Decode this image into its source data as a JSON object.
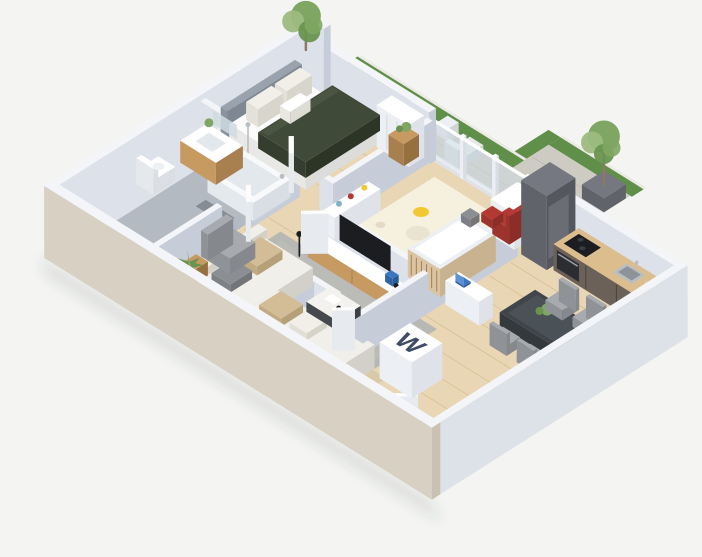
{
  "meta": {
    "description": "3D isometric floor-plan rendering of a two-bedroom apartment with wrap-around terrace",
    "view": "isometric-render",
    "background": "#f4f4f2"
  },
  "palette": {
    "bg": "#f4f4f2",
    "wallTop": "#f3f5f8",
    "wallFace": "#dde2ea",
    "wallFaceDark": "#c6cdd8",
    "wallBeige": "#d7d0c3",
    "wallBeigeDark": "#c9c1b1",
    "glass": "#cfe0e8",
    "floorWood": "#e9d6b4",
    "floorWoodLine": "#d8c094",
    "floorBath": "#b4bac2",
    "floorWc": "#ced2d8",
    "rugGray": "#b7b7b4",
    "rugCream": "#f6f0df",
    "paving": "#cecbc3",
    "curb": "#eceae4",
    "grass": "#5f8f49",
    "treeGreen": "#7fa763",
    "treeLight": "#9cbb80",
    "treeDark": "#69934f",
    "trunk": "#8a7a66",
    "duvet": "#404a38",
    "headboard": "#9aa3ad",
    "mattress": "#fbfbfb",
    "pillow": "#f1efe8",
    "wood": "#c79a62",
    "woodDark": "#a87f4e",
    "white": "#ffffff",
    "offWhite": "#eceff3",
    "tub": "#f7f9fa",
    "tubIn": "#e2e8ec",
    "steel": "#b9bec4",
    "black": "#1b1d21",
    "darkGray": "#55585e",
    "midGray": "#9aa0a6",
    "sofa": "#f0efea",
    "sofaSide": "#dedcd5",
    "cushTan": "#d2bd96",
    "cushGray": "#8b8e92",
    "tableDark": "#3f454a",
    "tableSheen": "#555d63",
    "chair": "#a7abaf",
    "chairDark": "#8f9397",
    "red": "#b23a32",
    "yellow": "#f0c832",
    "blue": "#3a77c2",
    "navy": "#3f4c63",
    "counter": "#dcbd8e",
    "cabinet": "#6b6158",
    "cabinetDark": "#594f46",
    "tower": "#757880",
    "towerDark": "#60636a",
    "matTan": "#d9c9a7",
    "matGray": "#9aa0a8",
    "oven": "#2c2d31",
    "shadow": "rgba(60,62,70,0.12)"
  },
  "scene": {
    "monogram": "W",
    "rooms": [
      {
        "name": "master-bedroom",
        "floor": "wood",
        "furniture": [
          "double-bed",
          "gray-headboard",
          "green-duvet",
          "pillows",
          "round-bedside-table",
          "potted-plant",
          "wardrobe-closet",
          "towel-shelf"
        ]
      },
      {
        "name": "bathroom",
        "floor": "gray-tile",
        "furniture": [
          "bathtub",
          "shower-fixture",
          "wood-vanity-sink",
          "toilet",
          "bath-mat",
          "mirror"
        ]
      },
      {
        "name": "kids-room",
        "floor": "wood-with-cream-rug",
        "furniture": [
          "crib",
          "red-armchair",
          "cube-shelf",
          "low-shelf",
          "play-cushions",
          "rug-decals"
        ]
      },
      {
        "name": "living-room",
        "floor": "wood-with-gray-rug",
        "furniture": [
          "corner-sofa",
          "seat-cushions",
          "coffee-table",
          "magazine",
          "armchair",
          "side-table",
          "tv-sideboard",
          "wall-tv",
          "picture-frame",
          "floor-lamp",
          "palm-plant"
        ]
      },
      {
        "name": "kitchen",
        "floor": "wood",
        "furniture": [
          "tall-cabinet-column",
          "counter-cabinets",
          "cooktop",
          "oven",
          "sink",
          "bottles"
        ]
      },
      {
        "name": "dining-area",
        "floor": "wood",
        "furniture": [
          "dining-table",
          "dining-chairs-x4",
          "table-plant"
        ]
      },
      {
        "name": "wc",
        "floor": "light-tile",
        "furniture": [
          "toilet"
        ]
      },
      {
        "name": "entry-hall",
        "floor": "wood",
        "furniture": [
          "monogram-wardrobe",
          "desk-with-laptop",
          "beige-doormat",
          "gray-doormat",
          "front-door"
        ]
      },
      {
        "name": "terrace",
        "floor": "stone-paving",
        "furniture": [
          "grass-border",
          "bistro-table",
          "bistro-chairs-x2",
          "lounge-chair",
          "planter-tree",
          "corner-tree",
          "glass-balustrade"
        ]
      }
    ]
  }
}
